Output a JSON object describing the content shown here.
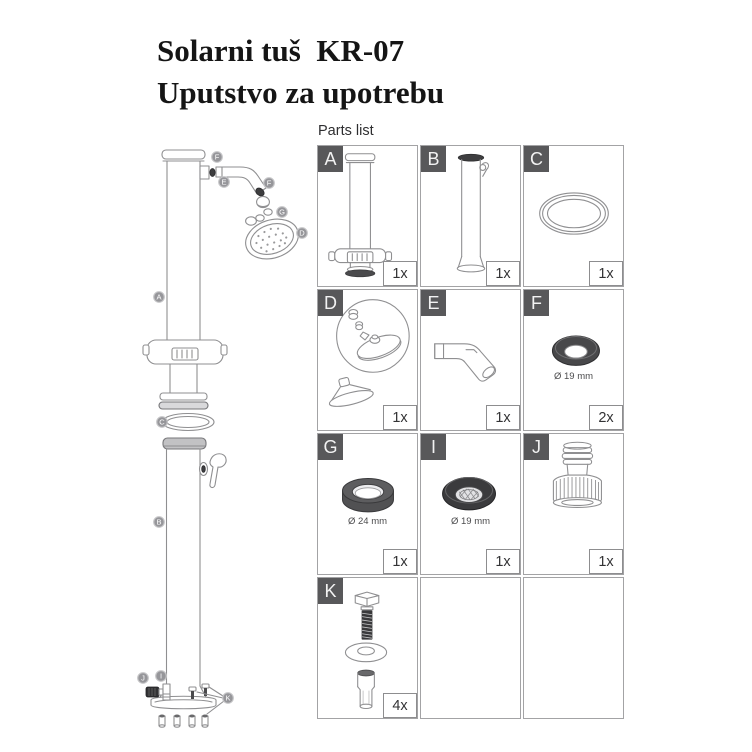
{
  "page": {
    "title_line1": "Solarni tuš  KR-07",
    "title_line2": "Uputstvo za upotrebu"
  },
  "parts_list": {
    "heading": "Parts list",
    "parts": [
      {
        "id": "A",
        "qty": "1x"
      },
      {
        "id": "B",
        "qty": "1x"
      },
      {
        "id": "C",
        "qty": "1x"
      },
      {
        "id": "D",
        "qty": "1x"
      },
      {
        "id": "E",
        "qty": "1x"
      },
      {
        "id": "F",
        "qty": "2x",
        "note": "Ø 19 mm"
      },
      {
        "id": "G",
        "qty": "1x",
        "note": "Ø 24 mm"
      },
      {
        "id": "I",
        "qty": "1x",
        "note": "Ø 19 mm"
      },
      {
        "id": "J",
        "qty": "1x"
      },
      {
        "id": "K",
        "qty": "4x"
      }
    ]
  },
  "diagram": {
    "callouts": [
      {
        "letter": "F"
      },
      {
        "letter": "E"
      },
      {
        "letter": "F"
      },
      {
        "letter": "G"
      },
      {
        "letter": "D"
      },
      {
        "letter": "A"
      },
      {
        "letter": "C"
      },
      {
        "letter": "B"
      },
      {
        "letter": "J"
      },
      {
        "letter": "I"
      },
      {
        "letter": "K"
      }
    ]
  },
  "colors": {
    "label_box": "#58585a",
    "line_art": "#8f8f91",
    "dark_part": "#3d3d3f",
    "grid_border": "#a3a3a5"
  }
}
